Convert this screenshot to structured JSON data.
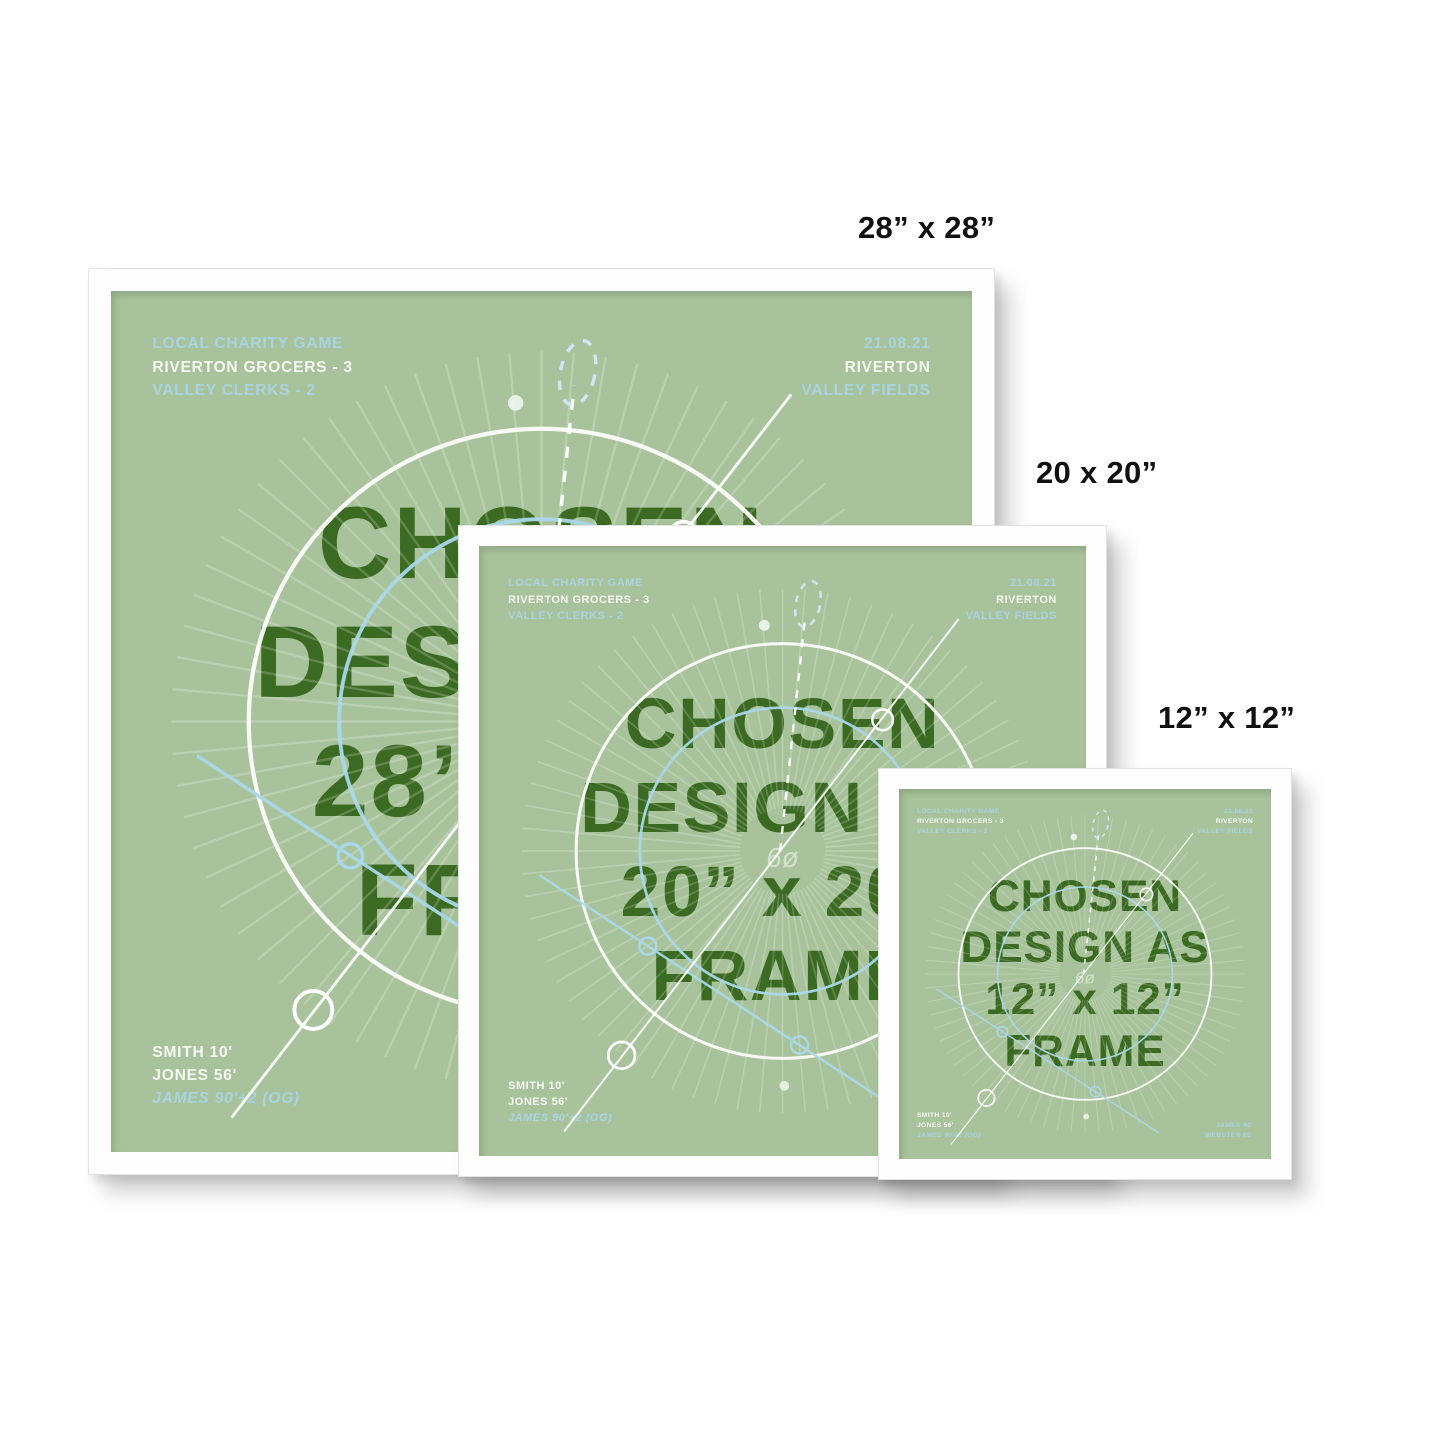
{
  "labels": {
    "large": "28” x 28”",
    "medium": "20 x 20”",
    "small": "12” x 12”"
  },
  "posters": {
    "large": {
      "header_left": [
        "LOCAL CHARITY GAME",
        "RIVERTON GROCERS - 3",
        "VALLEY CLERKS - 2"
      ],
      "header_right": [
        "21.08.21",
        "RIVERTON",
        "VALLEY FIELDS"
      ],
      "title": [
        "CHOSEN",
        "DESIGN AS",
        "28” x 28”",
        "FRAME"
      ],
      "scorers_left": [
        "SMITH 10'",
        "JONES 56'",
        "JAMES 90'+2 (OG)"
      ]
    },
    "medium": {
      "header_left": [
        "LOCAL CHARITY GAME",
        "RIVERTON GROCERS - 3",
        "VALLEY CLERKS - 2"
      ],
      "header_right": [
        "21.08.21",
        "RIVERTON",
        "VALLEY FIELDS"
      ],
      "title": [
        "CHOSEN",
        "DESIGN AS",
        "20” x 20”",
        "FRAME"
      ],
      "scorers_left": [
        "SMITH 10'",
        "JONES 56'",
        "JAMES 90'+2 (OG)"
      ]
    },
    "small": {
      "header_left": [
        "LOCAL CHARITY GAME",
        "RIVERTON GROCERS - 3",
        "VALLEY CLERKS - 2"
      ],
      "header_right": [
        "21.08.21",
        "RIVERTON",
        "VALLEY FIELDS"
      ],
      "title": [
        "CHOSEN",
        "DESIGN AS",
        "12” x 12”",
        "FRAME"
      ],
      "scorers_left": [
        "SMITH 10'",
        "JONES 56'",
        "JAMES 90'+2 (OG)"
      ],
      "scorers_right": [
        "JAMES 40'",
        "WEBSTER 65'"
      ]
    }
  },
  "watermark": "6ø",
  "colors": {
    "poster_green": "#a8c39b",
    "title_green": "#3b6a22",
    "pale_blue": "#a9d3e0",
    "white_text": "#f6f8f2",
    "frame_white": "#fefefe",
    "label_black": "#111111"
  }
}
